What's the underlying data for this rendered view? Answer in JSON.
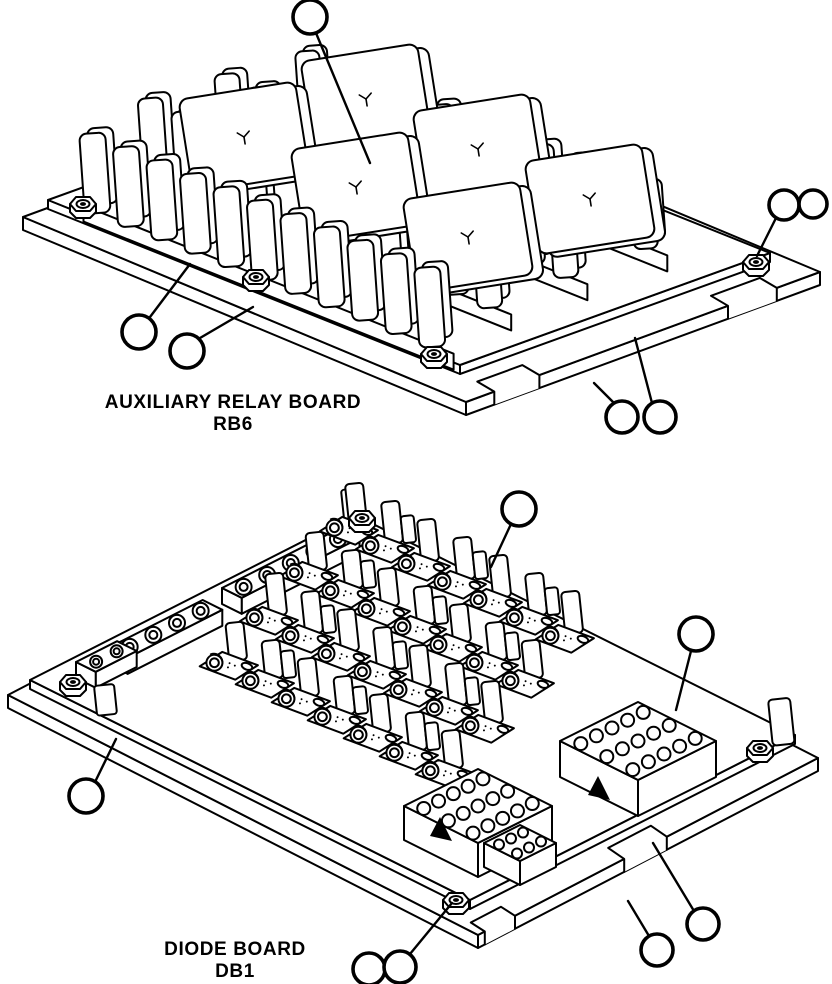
{
  "figure": {
    "stroke_color": "#000000",
    "background": "#ffffff",
    "line_width": 2,
    "callout_line_width": 3.6
  },
  "boards": [
    {
      "id": "rb6",
      "title": "AUXILIARY RELAY BOARD",
      "subtitle": "RB6",
      "axes": {
        "origin": [
          48,
          200
        ],
        "a": [
          0.93,
          0.372
        ],
        "b": [
          0.94,
          -0.339
        ]
      },
      "parts": [
        {
          "type": "plate",
          "corners": [
            [
              23,
              217
            ],
            [
              466,
              402
            ],
            [
              820,
              272
            ],
            [
              377,
              87
            ]
          ],
          "th": 13
        },
        {
          "type": "notch",
          "from": [
            466,
            402
          ],
          "to": [
            820,
            272
          ],
          "f": 0.08,
          "w": 48,
          "depth": [
            -17,
            -10
          ],
          "th": 13
        },
        {
          "type": "notch",
          "from": [
            466,
            402
          ],
          "to": [
            820,
            272
          ],
          "f": 0.74,
          "w": 52,
          "depth": [
            -17,
            -10
          ],
          "th": 13
        },
        {
          "type": "plate",
          "corners": [
            [
              48,
              200
            ],
            [
              460,
              365
            ],
            [
              770,
              253
            ],
            [
              358,
              88
            ]
          ],
          "th": 9
        },
        {
          "type": "finRow",
          "t": 272,
          "s0": 8,
          "n": 11,
          "step": 36,
          "h": 60,
          "w": 24
        },
        {
          "type": "finRow",
          "t": 187,
          "s0": 8,
          "n": 11,
          "step": 36,
          "h": 66,
          "w": 25
        },
        {
          "type": "relay",
          "c": [
            366,
            99
          ],
          "w": 118,
          "h": 94,
          "rot": -9
        },
        {
          "type": "relay",
          "c": [
            478,
            149
          ],
          "w": 118,
          "h": 94,
          "rot": -9
        },
        {
          "type": "relay",
          "c": [
            590,
            199
          ],
          "w": 118,
          "h": 94,
          "rot": -9
        },
        {
          "type": "finRow",
          "t": 102,
          "s0": 12,
          "n": 11,
          "step": 36,
          "h": 72,
          "w": 25
        },
        {
          "type": "relay",
          "c": [
            244,
            137
          ],
          "w": 118,
          "h": 94,
          "rot": -9
        },
        {
          "type": "relay",
          "c": [
            356,
            187
          ],
          "w": 118,
          "h": 94,
          "rot": -9
        },
        {
          "type": "relay",
          "c": [
            468,
            237
          ],
          "w": 118,
          "h": 94,
          "rot": -9
        },
        {
          "type": "finRow",
          "t": 15,
          "s0": 38,
          "n": 11,
          "step": 36,
          "h": 76,
          "w": 26
        },
        {
          "type": "nut",
          "c": [
            83,
            204
          ]
        },
        {
          "type": "nut",
          "c": [
            256,
            277
          ]
        },
        {
          "type": "nut",
          "c": [
            434,
            354
          ]
        },
        {
          "type": "nut",
          "c": [
            756,
            262
          ]
        }
      ],
      "callouts": [
        {
          "c": [
            310,
            17
          ],
          "r": 17,
          "leader": [
            [
              316,
              33
            ],
            [
              370,
              163
            ]
          ]
        },
        {
          "c": [
            784,
            205
          ],
          "r": 15,
          "leader": [
            [
              776,
              218
            ],
            [
              757,
              256
            ]
          ]
        },
        {
          "c": [
            813,
            204
          ],
          "r": 14,
          "leader": null
        },
        {
          "c": [
            139,
            332
          ],
          "r": 17,
          "leader": [
            [
              150,
              317
            ],
            [
              190,
              264
            ]
          ]
        },
        {
          "c": [
            187,
            351
          ],
          "r": 17,
          "leader": [
            [
              200,
              338
            ],
            [
              253,
              307
            ]
          ]
        },
        {
          "c": [
            622,
            417
          ],
          "r": 16,
          "leader": [
            [
              614,
              403
            ],
            [
              594,
              383
            ]
          ]
        },
        {
          "c": [
            660,
            417
          ],
          "r": 16,
          "leader": [
            [
              652,
              403
            ],
            [
              635,
              338
            ]
          ]
        }
      ]
    },
    {
      "id": "db1",
      "title": "DIODE BOARD",
      "subtitle": "DB1",
      "axes": {
        "origin": [
          30,
          680
        ],
        "a": [
          0.894,
          0.447
        ],
        "b": [
          0.893,
          -0.453
        ]
      },
      "parts": [
        {
          "type": "plate",
          "corners": [
            [
              8,
              695
            ],
            [
              478,
              935
            ],
            [
              818,
              758
            ],
            [
              348,
              518
            ]
          ],
          "th": 13
        },
        {
          "type": "notch",
          "from": [
            478,
            935
          ],
          "to": [
            818,
            758
          ],
          "f": 0.43,
          "w": 48,
          "depth": [
            -16,
            -11
          ],
          "th": 13
        },
        {
          "type": "notch",
          "from": [
            478,
            935
          ],
          "to": [
            818,
            758
          ],
          "f": 0.02,
          "w": 34,
          "depth": [
            -14,
            -9
          ],
          "th": 13
        },
        {
          "type": "plate",
          "corners": [
            [
              30,
              680
            ],
            [
              470,
              900
            ],
            [
              795,
              735
            ],
            [
              355,
              515
            ]
          ],
          "th": 9
        },
        {
          "type": "box",
          "x": 768,
          "y": 700,
          "w": 22,
          "h": 46,
          "rx": 4,
          "rot": -6
        },
        {
          "type": "box",
          "x": 341,
          "y": 490,
          "w": 16,
          "h": 32,
          "rx": 3,
          "rot": -6
        },
        {
          "type": "strip",
          "p": [
            222,
            588
          ],
          "len": 132,
          "holes": 5,
          "holeR": 8
        },
        {
          "type": "strip",
          "p": [
            108,
            648
          ],
          "len": 106,
          "holes": 4,
          "holeR": 8
        },
        {
          "type": "strip",
          "p": [
            76,
            662
          ],
          "len": 46,
          "holes": 2,
          "holeR": 6
        },
        {
          "type": "diodeGrid",
          "origin": [
            222,
            668
          ],
          "rowOff": [
            40,
            -45
          ],
          "colStep": [
            36,
            18
          ],
          "rows": 4,
          "cols": 7
        },
        {
          "type": "connector",
          "corners": [
            [
              560,
              741
            ],
            [
              638,
              780
            ],
            [
              716,
              741
            ],
            [
              638,
              702
            ]
          ],
          "rows": 3,
          "cols": 5,
          "r": 6.5,
          "depth": 36,
          "arrow": [
            [
              588,
              795
            ],
            [
              610,
              800
            ],
            [
              598,
              776
            ]
          ]
        },
        {
          "type": "connector",
          "corners": [
            [
              404,
              806
            ],
            [
              478,
              843
            ],
            [
              552,
              806
            ],
            [
              478,
              769
            ]
          ],
          "rows": 3,
          "cols": 5,
          "r": 6.5,
          "depth": 34,
          "arrow": [
            [
              430,
              836
            ],
            [
              452,
              841
            ],
            [
              440,
              817
            ]
          ]
        },
        {
          "type": "connector",
          "corners": [
            [
              484,
              843
            ],
            [
              520,
              861
            ],
            [
              556,
              843
            ],
            [
              520,
              825
            ]
          ],
          "rows": 2,
          "cols": 3,
          "r": 5,
          "depth": 24,
          "arrow": null
        },
        {
          "type": "box",
          "x": 94,
          "y": 686,
          "w": 20,
          "h": 30,
          "rx": 3,
          "rot": -6
        },
        {
          "type": "nut",
          "c": [
            73,
            682
          ]
        },
        {
          "type": "nut",
          "c": [
            760,
            748
          ]
        },
        {
          "type": "nut",
          "c": [
            456,
            900
          ]
        },
        {
          "type": "nut",
          "c": [
            362,
            518
          ]
        }
      ],
      "callouts": [
        {
          "c": [
            519,
            509
          ],
          "r": 17,
          "leader": [
            [
              511,
              524
            ],
            [
              491,
              567
            ]
          ]
        },
        {
          "c": [
            696,
            634
          ],
          "r": 17,
          "leader": [
            [
              691,
              651
            ],
            [
              676,
              710
            ]
          ]
        },
        {
          "c": [
            86,
            796
          ],
          "r": 17,
          "leader": [
            [
              95,
              782
            ],
            [
              116,
              739
            ]
          ]
        },
        {
          "c": [
            369,
            969
          ],
          "r": 16,
          "leader": null
        },
        {
          "c": [
            400,
            967
          ],
          "r": 16,
          "leader": [
            [
              410,
              954
            ],
            [
              452,
              903
            ]
          ]
        },
        {
          "c": [
            657,
            950
          ],
          "r": 16,
          "leader": [
            [
              649,
              936
            ],
            [
              628,
              901
            ]
          ]
        },
        {
          "c": [
            703,
            924
          ],
          "r": 16,
          "leader": [
            [
              694,
              911
            ],
            [
              653,
              843
            ]
          ]
        }
      ]
    }
  ]
}
